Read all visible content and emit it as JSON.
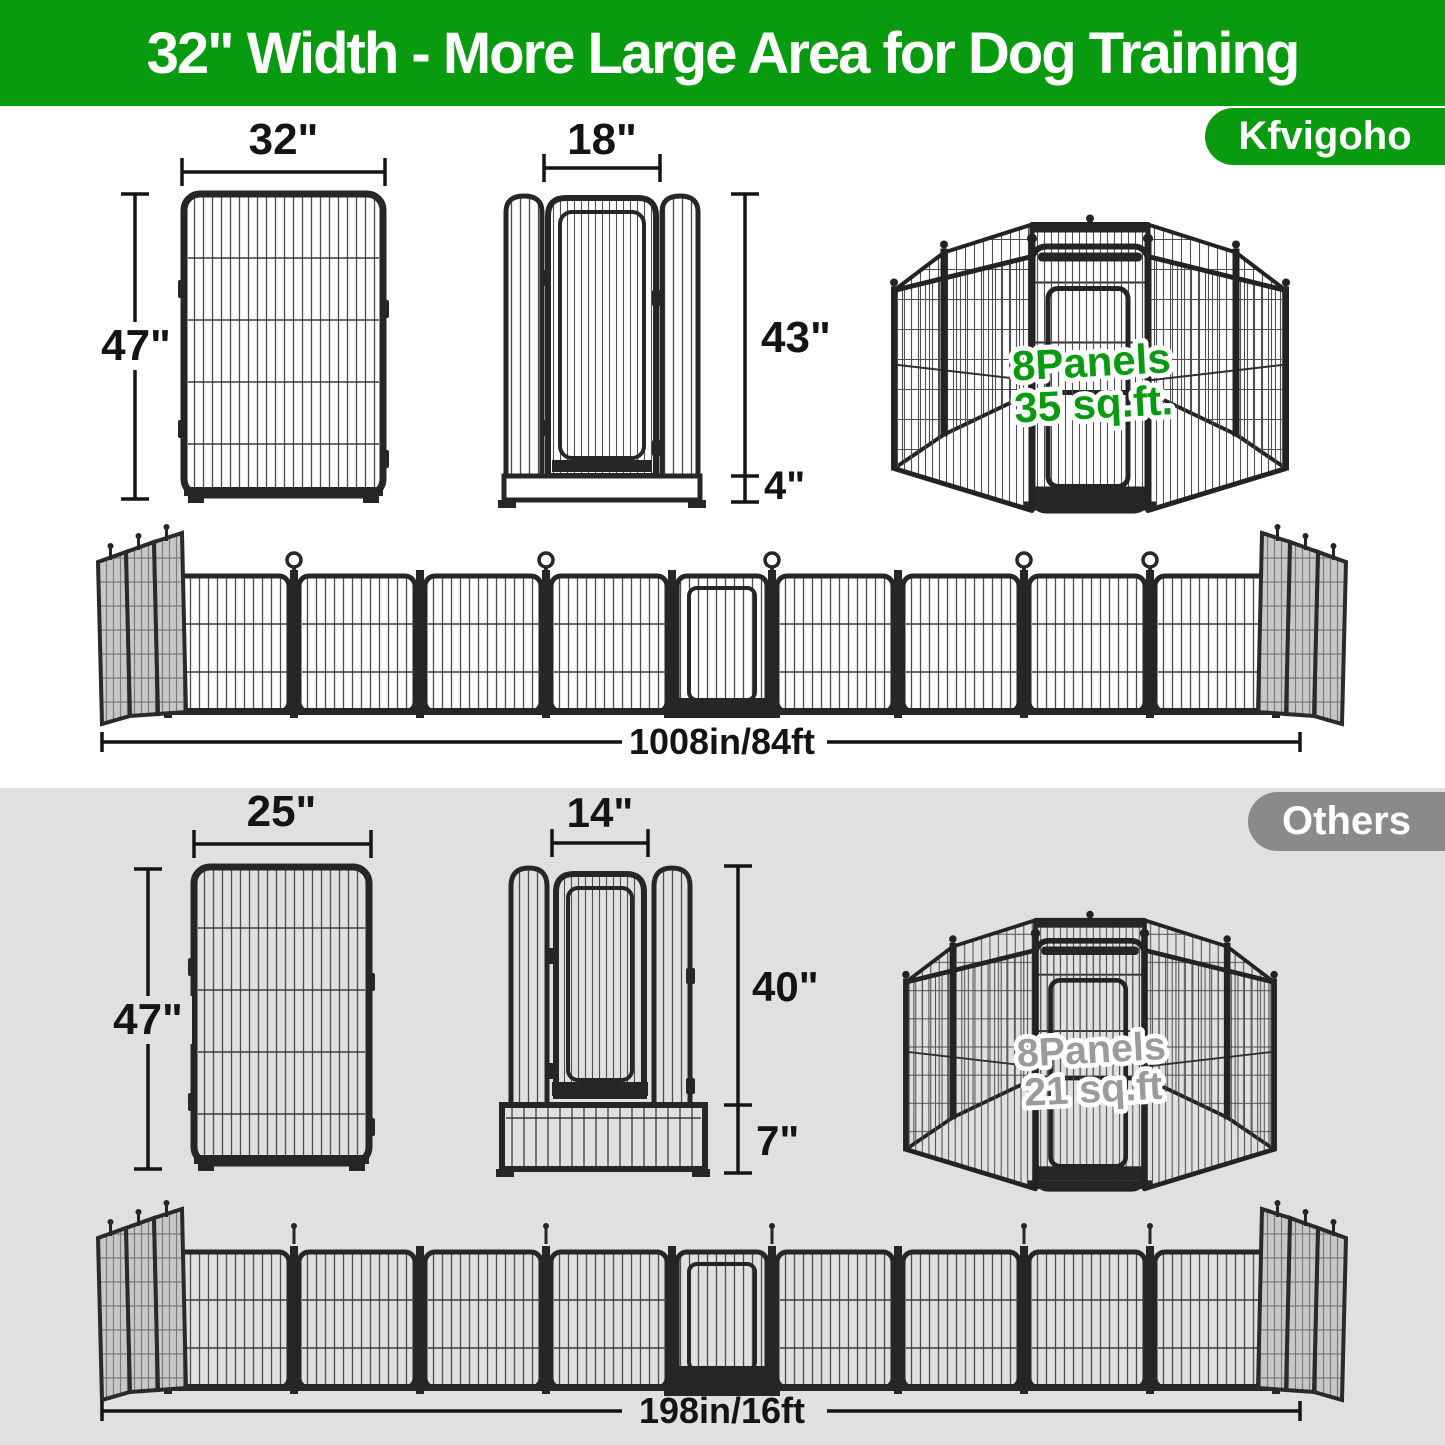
{
  "banner": {
    "title": "32\" Width - More Large Area for Dog Training"
  },
  "brand_badge": {
    "label": "Kfvigoho"
  },
  "others_badge": {
    "label": "Others"
  },
  "kfvigoho": {
    "panel": {
      "width": "32\"",
      "height": "47\""
    },
    "door_panel": {
      "door_width": "18\"",
      "door_height": "43\"",
      "bottom_height": "4\""
    },
    "pen": {
      "panels": "8Panels",
      "area": "35 sq.ft."
    },
    "row": {
      "total_length": "1008in/84ft"
    }
  },
  "others": {
    "panel": {
      "width": "25\"",
      "height": "47\""
    },
    "door_panel": {
      "door_width": "14\"",
      "door_height": "40\"",
      "bottom_height": "7\""
    },
    "pen": {
      "panels": "8Panels",
      "area": "21 sq.ft"
    },
    "row": {
      "total_length": "198in/16ft"
    }
  },
  "colors": {
    "brand_green": "#089b10",
    "badge_gray": "#8a8a8a",
    "section_gray": "#e0e0e0",
    "fence_dark": "#262626"
  }
}
